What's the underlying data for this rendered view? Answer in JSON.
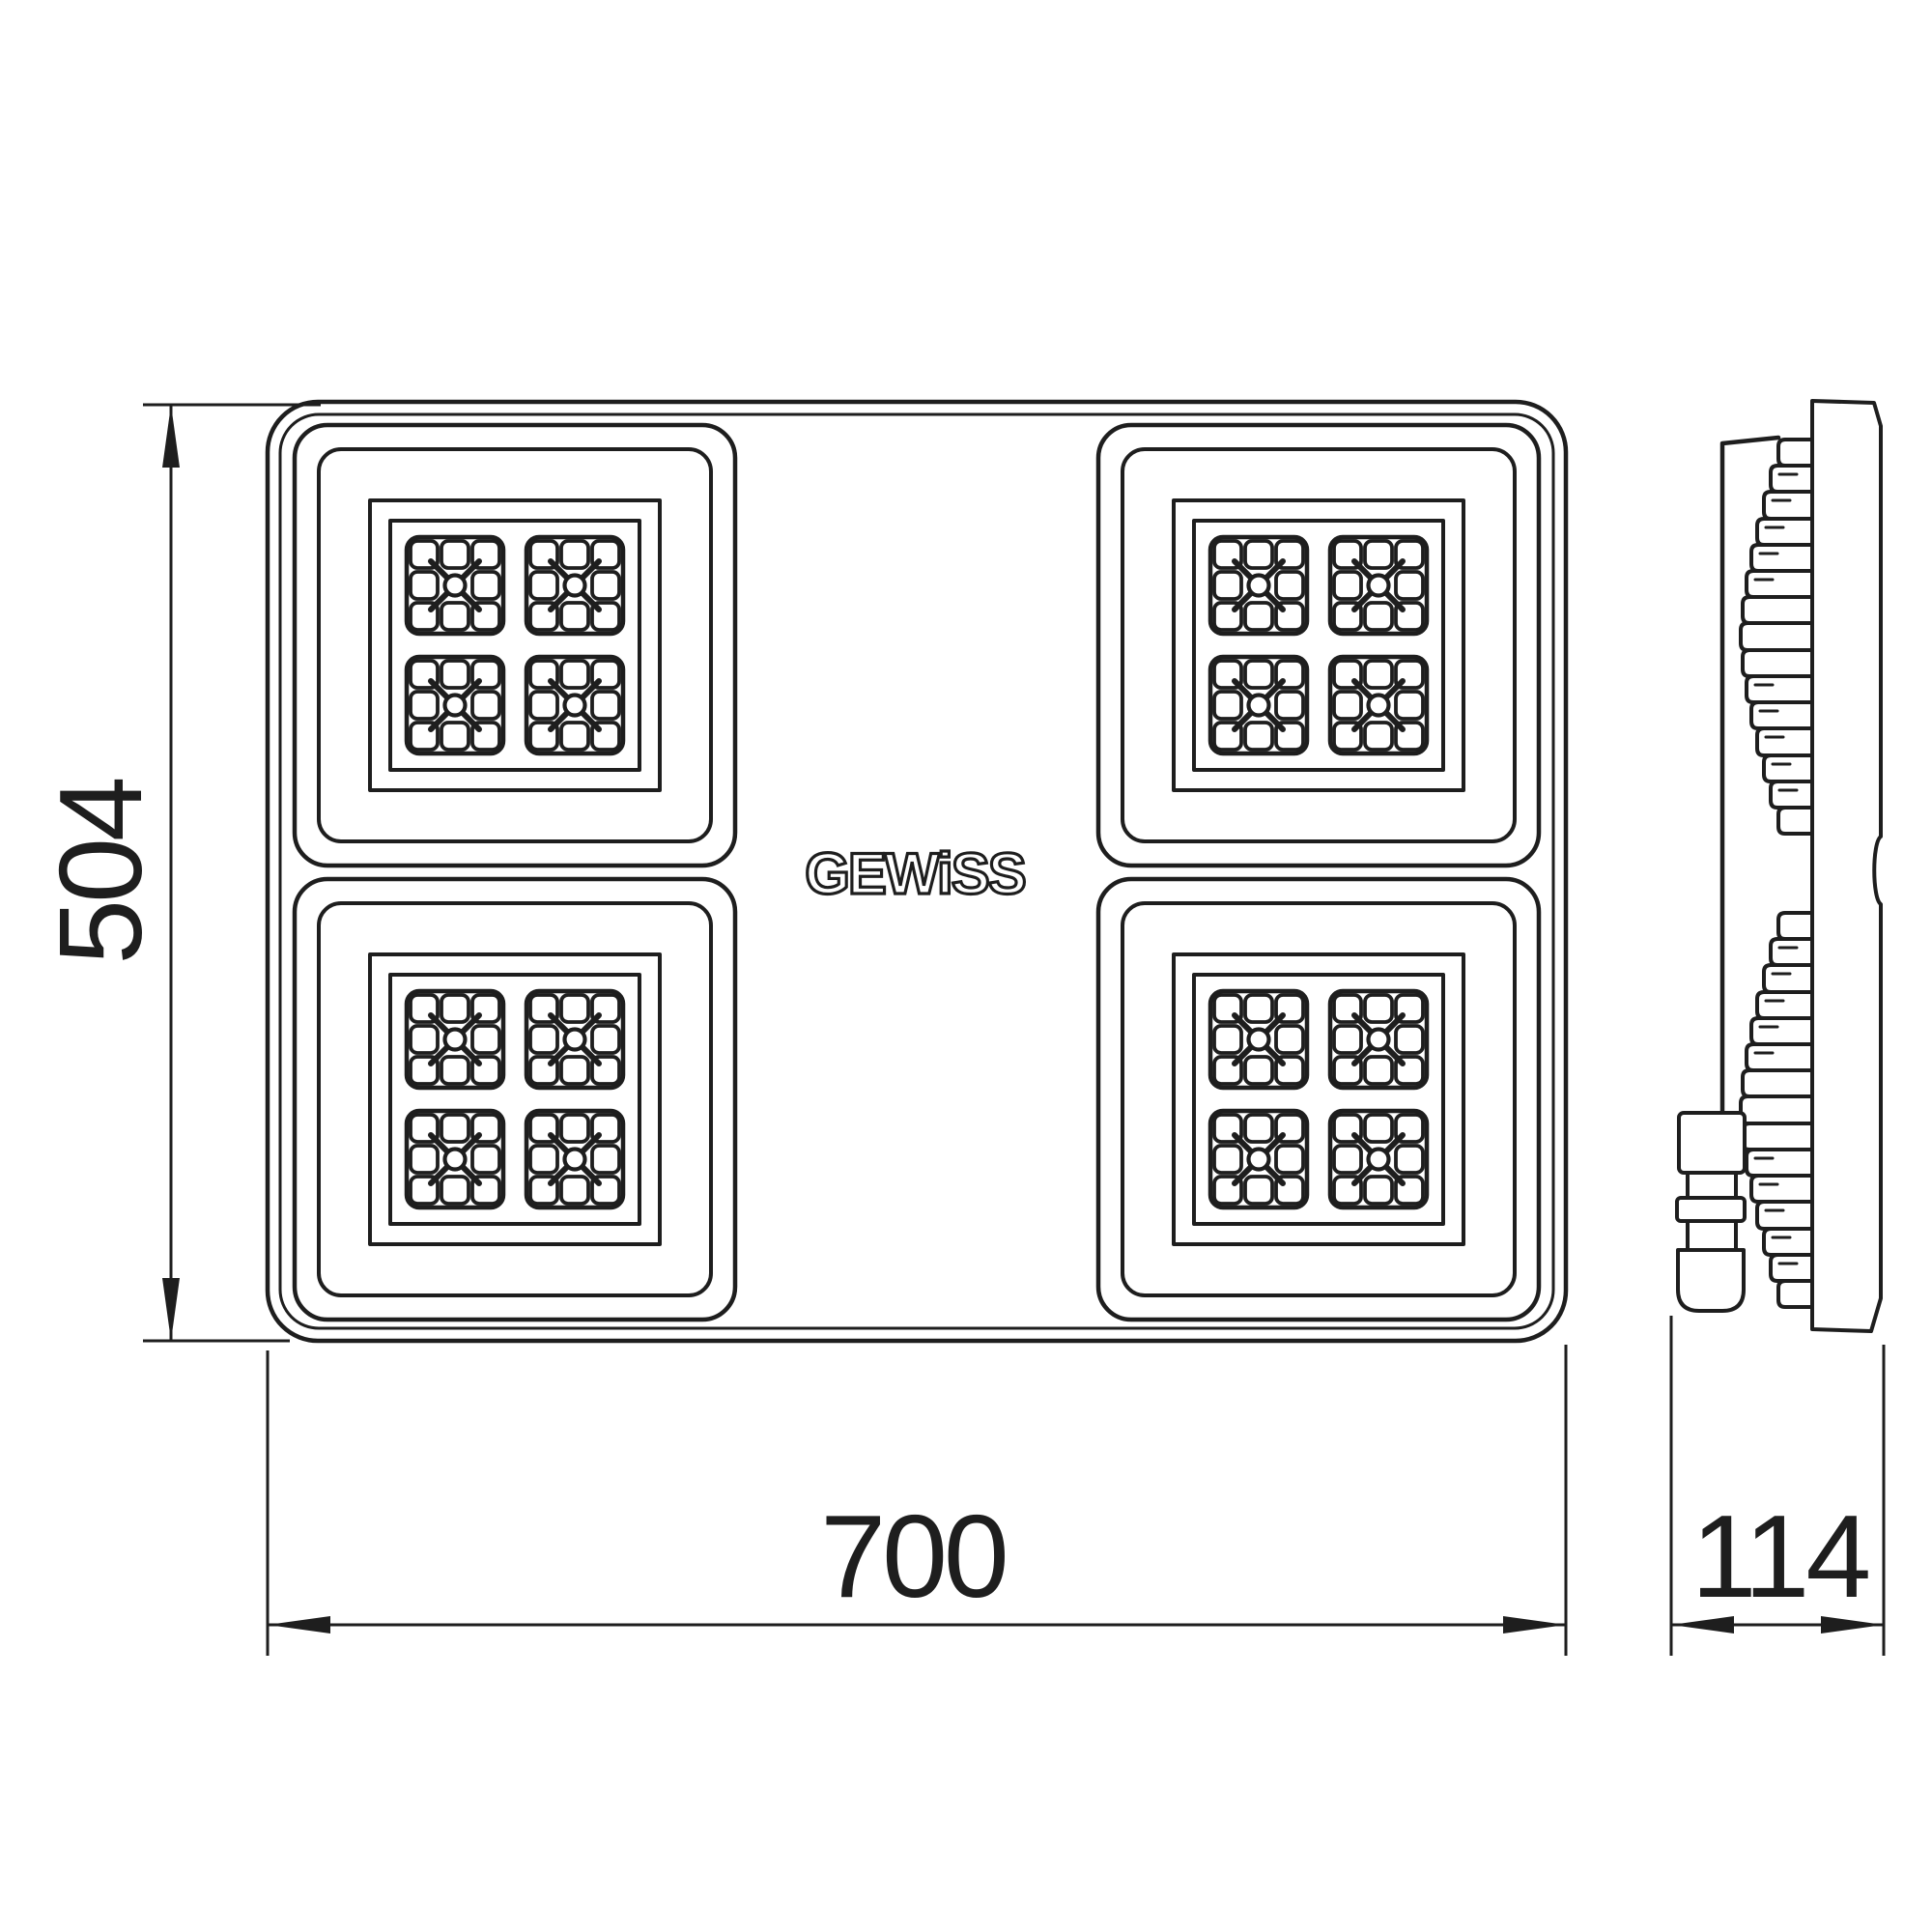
{
  "page": {
    "background": "#ffffff",
    "ink": "#1e1e1e"
  },
  "logo": {
    "text": "GEWiSS"
  },
  "dimensions": {
    "height": {
      "value": "504"
    },
    "width": {
      "value": "700"
    },
    "depth": {
      "value": "114"
    }
  },
  "front_view": {
    "led_modules": 4,
    "arrays_per_module": 4,
    "grid_per_array": "3x3"
  },
  "side_view": {
    "fin_clusters": 2,
    "has_cable_gland": true
  }
}
